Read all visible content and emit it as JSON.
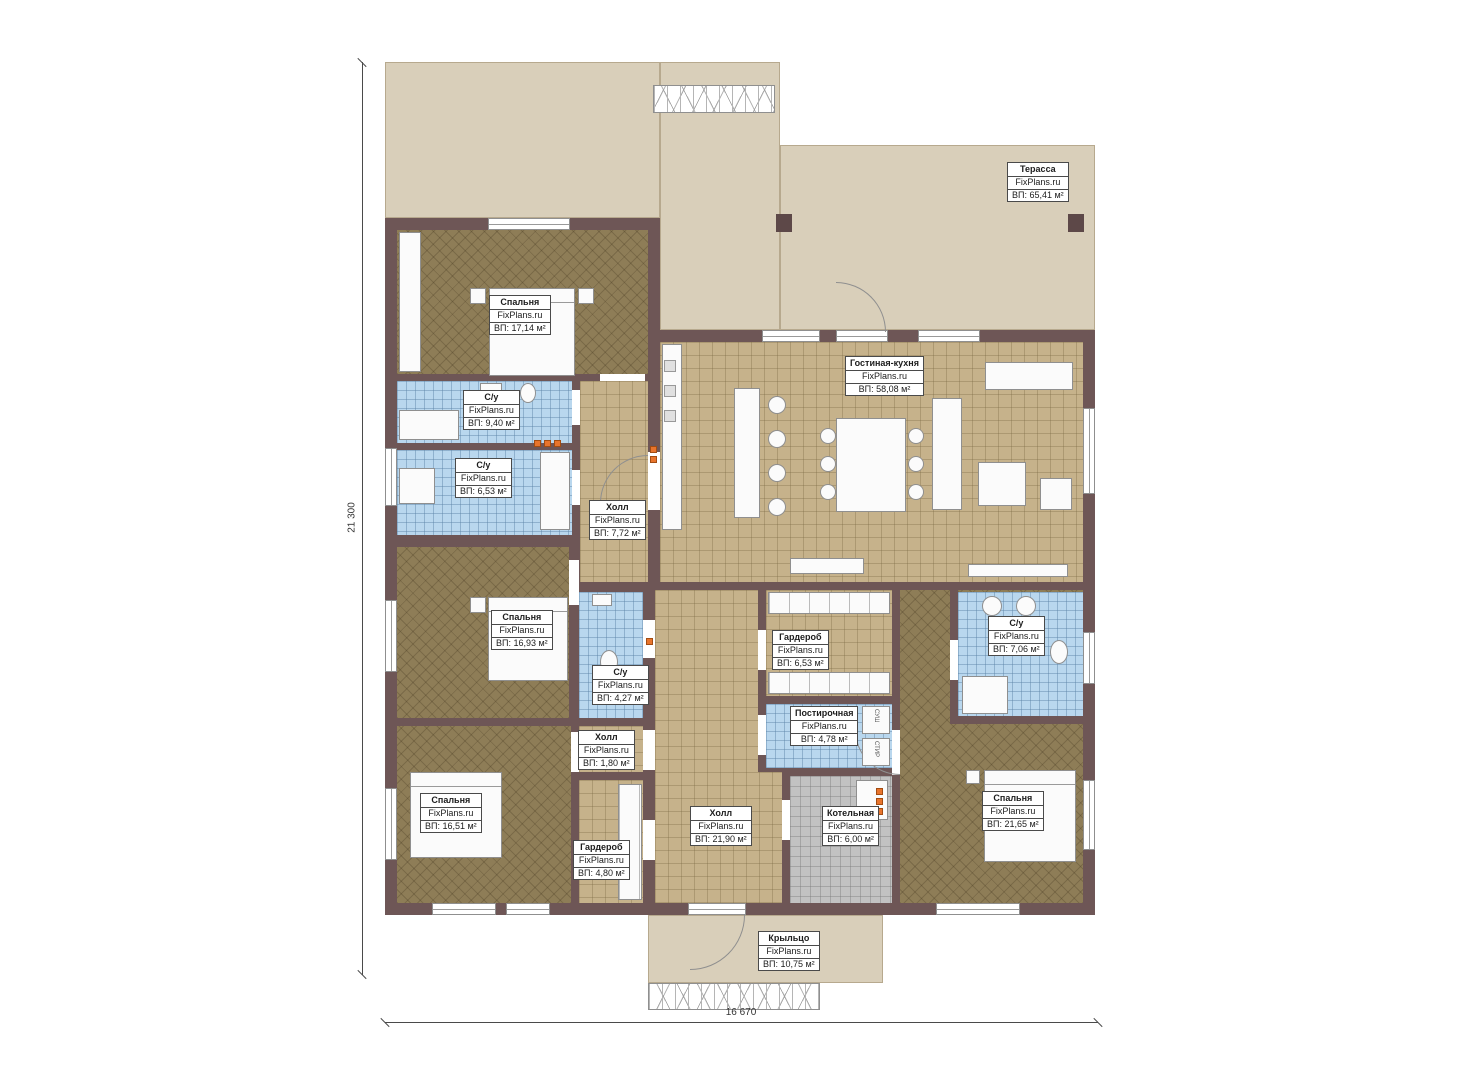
{
  "plan": {
    "watermark": "FixPlans.ru",
    "dim_left": "21 300",
    "dim_bottom": "16 670",
    "rooms": [
      {
        "name": "Терасса",
        "area": "ВП: 65,41 м²"
      },
      {
        "name": "Спальня",
        "area": "ВП: 17,14 м²"
      },
      {
        "name": "С/у",
        "area": "ВП: 9,40 м²"
      },
      {
        "name": "С/у",
        "area": "ВП: 6,53 м²"
      },
      {
        "name": "Холл",
        "area": "ВП: 7,72 м²"
      },
      {
        "name": "Гостиная-кухня",
        "area": "ВП: 58,08 м²"
      },
      {
        "name": "Спальня",
        "area": "ВП: 16,93 м²"
      },
      {
        "name": "Гардероб",
        "area": "ВП: 6,53 м²"
      },
      {
        "name": "С/у",
        "area": "ВП: 4,27 м²"
      },
      {
        "name": "С/у",
        "area": "ВП: 7,06 м²"
      },
      {
        "name": "Постирочная",
        "area": "ВП: 4,78 м²"
      },
      {
        "name": "Холл",
        "area": "ВП: 1,80 м²"
      },
      {
        "name": "Спальня",
        "area": "ВП: 16,51 м²"
      },
      {
        "name": "Гардероб",
        "area": "ВП: 4,80 м²"
      },
      {
        "name": "Холл",
        "area": "ВП: 21,90 м²"
      },
      {
        "name": "Котельная",
        "area": "ВП: 6,00 м²"
      },
      {
        "name": "Спальня",
        "area": "ВП: 21,65 м²"
      },
      {
        "name": "Крыльцо",
        "area": "ВП: 10,75 м²"
      }
    ],
    "laundry_appliances": [
      "СУШ",
      "СТИР"
    ],
    "colors": {
      "wall": "#6e5656",
      "tile_tan": "#c6b28b",
      "tile_blue": "#b9d7ee",
      "floor_brown": "#8e7d57",
      "tile_gray": "#c2c2c2",
      "terrace_beige": "#d9cfba",
      "marker_orange": "#e8742c"
    }
  }
}
